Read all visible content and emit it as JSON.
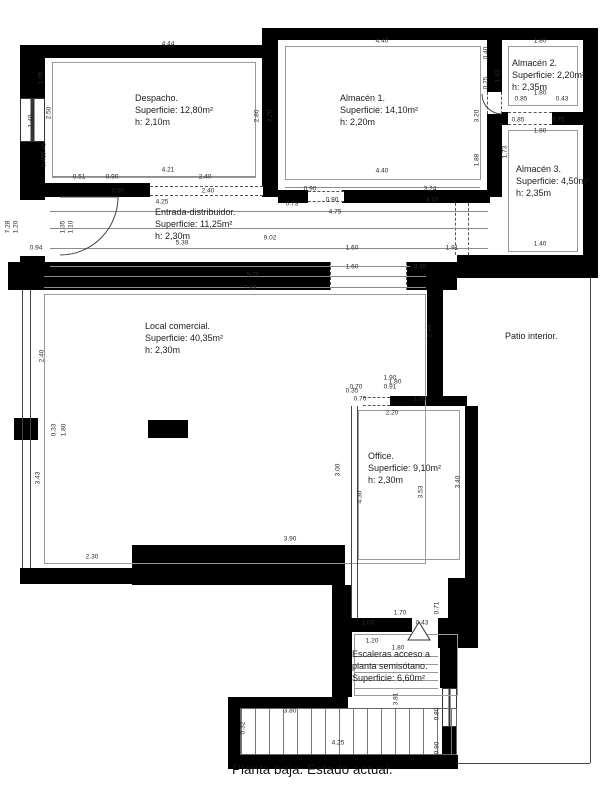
{
  "title": "Planta baja. Estado actual.",
  "colors": {
    "wall": "#000000",
    "line": "#8b8b8b",
    "dim_text": "#2a2a2a",
    "background": "#ffffff"
  },
  "rooms": {
    "despacho": {
      "line1": "Despacho.",
      "line2": "Superficie: 12,80m²",
      "line3": "h: 2,10m"
    },
    "almacen1": {
      "line1": "Almacén 1.",
      "line2": "Superficie: 14,10m²",
      "line3": "h: 2,20m"
    },
    "almacen2": {
      "line1": "Almacén 2.",
      "line2": "Superficie: 2,20m²",
      "line3": "h: 2,35m"
    },
    "almacen3": {
      "line1": "Almacén 3.",
      "line2": "Superficie: 4,50m²",
      "line3": "h: 2,35m"
    },
    "entrada": {
      "line1": "Entrada-distribuidor.",
      "line2": "Superficie: 11,25m²",
      "line3": "h: 2,30m"
    },
    "local": {
      "line1": "Local comercial.",
      "line2": "Superficie: 40,35m²",
      "line3": "h: 2,30m"
    },
    "office": {
      "line1": "Office.",
      "line2": "Superficie: 9,10m²",
      "line3": "h: 2,30m"
    },
    "patio": {
      "line1": "Patio interior.",
      "line2": "",
      "line3": ""
    },
    "escaleras": {
      "line1": "Escaleras acceso a",
      "line2": "planta semisótano.",
      "line3": "Superficie: 6,60m²"
    }
  },
  "dimensions": [
    {
      "t": "4.44",
      "x": 168,
      "y": 44
    },
    {
      "t": "4.21",
      "x": 168,
      "y": 170
    },
    {
      "t": "0.51",
      "x": 79,
      "y": 177
    },
    {
      "t": "0.90",
      "x": 112,
      "y": 177
    },
    {
      "t": "2.40",
      "x": 205,
      "y": 177
    },
    {
      "t": "1.05",
      "x": 41,
      "y": 78,
      "v": true
    },
    {
      "t": "2.50",
      "x": 49,
      "y": 113,
      "v": true
    },
    {
      "t": "1.40",
      "x": 31,
      "y": 121,
      "v": true
    },
    {
      "t": "0.45",
      "x": 44,
      "y": 149,
      "v": true
    },
    {
      "t": "0.45",
      "x": 44,
      "y": 161,
      "v": true
    },
    {
      "t": "2.80",
      "x": 257,
      "y": 116,
      "v": true
    },
    {
      "t": "3.20",
      "x": 270,
      "y": 116,
      "v": true
    },
    {
      "t": "4.40",
      "x": 382,
      "y": 41
    },
    {
      "t": "4.40",
      "x": 382,
      "y": 171
    },
    {
      "t": "3.24",
      "x": 430,
      "y": 189
    },
    {
      "t": "0.90",
      "x": 310,
      "y": 189
    },
    {
      "t": "3.20",
      "x": 477,
      "y": 116,
      "v": true
    },
    {
      "t": "1.88",
      "x": 477,
      "y": 160,
      "v": true
    },
    {
      "t": "0.40",
      "x": 486,
      "y": 53,
      "v": true
    },
    {
      "t": "0.75",
      "x": 486,
      "y": 83,
      "v": true
    },
    {
      "t": "1.43",
      "x": 498,
      "y": 76,
      "v": true
    },
    {
      "t": "1.80",
      "x": 540,
      "y": 41
    },
    {
      "t": "1.80",
      "x": 540,
      "y": 93
    },
    {
      "t": "0.85",
      "x": 521,
      "y": 99
    },
    {
      "t": "0.43",
      "x": 562,
      "y": 99
    },
    {
      "t": "0.85",
      "x": 518,
      "y": 120
    },
    {
      "t": "0.75",
      "x": 558,
      "y": 120
    },
    {
      "t": "1.80",
      "x": 540,
      "y": 131
    },
    {
      "t": "1.73",
      "x": 505,
      "y": 152,
      "v": true
    },
    {
      "t": "1.40",
      "x": 540,
      "y": 244
    },
    {
      "t": "0.90",
      "x": 118,
      "y": 191
    },
    {
      "t": "2.40",
      "x": 208,
      "y": 191
    },
    {
      "t": "4.25",
      "x": 162,
      "y": 202
    },
    {
      "t": "0.73",
      "x": 292,
      "y": 204
    },
    {
      "t": "0.90",
      "x": 332,
      "y": 200
    },
    {
      "t": "3.10",
      "x": 432,
      "y": 200
    },
    {
      "t": "4.75",
      "x": 335,
      "y": 212
    },
    {
      "t": "9.02",
      "x": 270,
      "y": 238
    },
    {
      "t": "5.39",
      "x": 182,
      "y": 243
    },
    {
      "t": "1.60",
      "x": 352,
      "y": 248
    },
    {
      "t": "1.91",
      "x": 452,
      "y": 248
    },
    {
      "t": "1.60",
      "x": 352,
      "y": 267
    },
    {
      "t": "0.45",
      "x": 420,
      "y": 267
    },
    {
      "t": "1.35",
      "x": 63,
      "y": 227,
      "v": true
    },
    {
      "t": "1.10",
      "x": 71,
      "y": 227,
      "v": true
    },
    {
      "t": "7.28",
      "x": 8,
      "y": 227,
      "v": true
    },
    {
      "t": "1.20",
      "x": 16,
      "y": 227,
      "v": true
    },
    {
      "t": "0.94",
      "x": 36,
      "y": 248
    },
    {
      "t": "5.70",
      "x": 253,
      "y": 275
    },
    {
      "t": "7.93",
      "x": 250,
      "y": 288
    },
    {
      "t": "2.40",
      "x": 42,
      "y": 356,
      "v": true
    },
    {
      "t": "3.43",
      "x": 38,
      "y": 478,
      "v": true
    },
    {
      "t": "0.33",
      "x": 54,
      "y": 430,
      "v": true
    },
    {
      "t": "1.80",
      "x": 64,
      "y": 430,
      "v": true
    },
    {
      "t": "2.30",
      "x": 92,
      "y": 557
    },
    {
      "t": "3.90",
      "x": 290,
      "y": 539
    },
    {
      "t": "2.44",
      "x": 430,
      "y": 331,
      "v": true
    },
    {
      "t": "1.90",
      "x": 390,
      "y": 378
    },
    {
      "t": "0.35",
      "x": 352,
      "y": 391
    },
    {
      "t": "0.70",
      "x": 356,
      "y": 387
    },
    {
      "t": "0.91",
      "x": 390,
      "y": 387
    },
    {
      "t": "1.80",
      "x": 395,
      "y": 382
    },
    {
      "t": "0.70",
      "x": 360,
      "y": 399
    },
    {
      "t": "1.30",
      "x": 420,
      "y": 399
    },
    {
      "t": "2.20",
      "x": 392,
      "y": 413
    },
    {
      "t": "3.00",
      "x": 338,
      "y": 470,
      "v": true
    },
    {
      "t": "4.30",
      "x": 360,
      "y": 497,
      "v": true
    },
    {
      "t": "3.53",
      "x": 421,
      "y": 492,
      "v": true
    },
    {
      "t": "3.40",
      "x": 458,
      "y": 482,
      "v": true
    },
    {
      "t": "0.71",
      "x": 437,
      "y": 608,
      "v": true
    },
    {
      "t": "1.70",
      "x": 400,
      "y": 613
    },
    {
      "t": "1.03",
      "x": 368,
      "y": 623
    },
    {
      "t": "0.43",
      "x": 422,
      "y": 623
    },
    {
      "t": "1.20",
      "x": 372,
      "y": 641
    },
    {
      "t": "1.80",
      "x": 398,
      "y": 648
    },
    {
      "t": "3.80",
      "x": 290,
      "y": 711
    },
    {
      "t": "4.25",
      "x": 338,
      "y": 743
    },
    {
      "t": "0.32",
      "x": 243,
      "y": 728,
      "v": true
    },
    {
      "t": "3.81",
      "x": 396,
      "y": 699,
      "v": true
    },
    {
      "t": "0.80",
      "x": 437,
      "y": 714,
      "v": true
    },
    {
      "t": "0.90",
      "x": 437,
      "y": 748,
      "v": true
    }
  ]
}
